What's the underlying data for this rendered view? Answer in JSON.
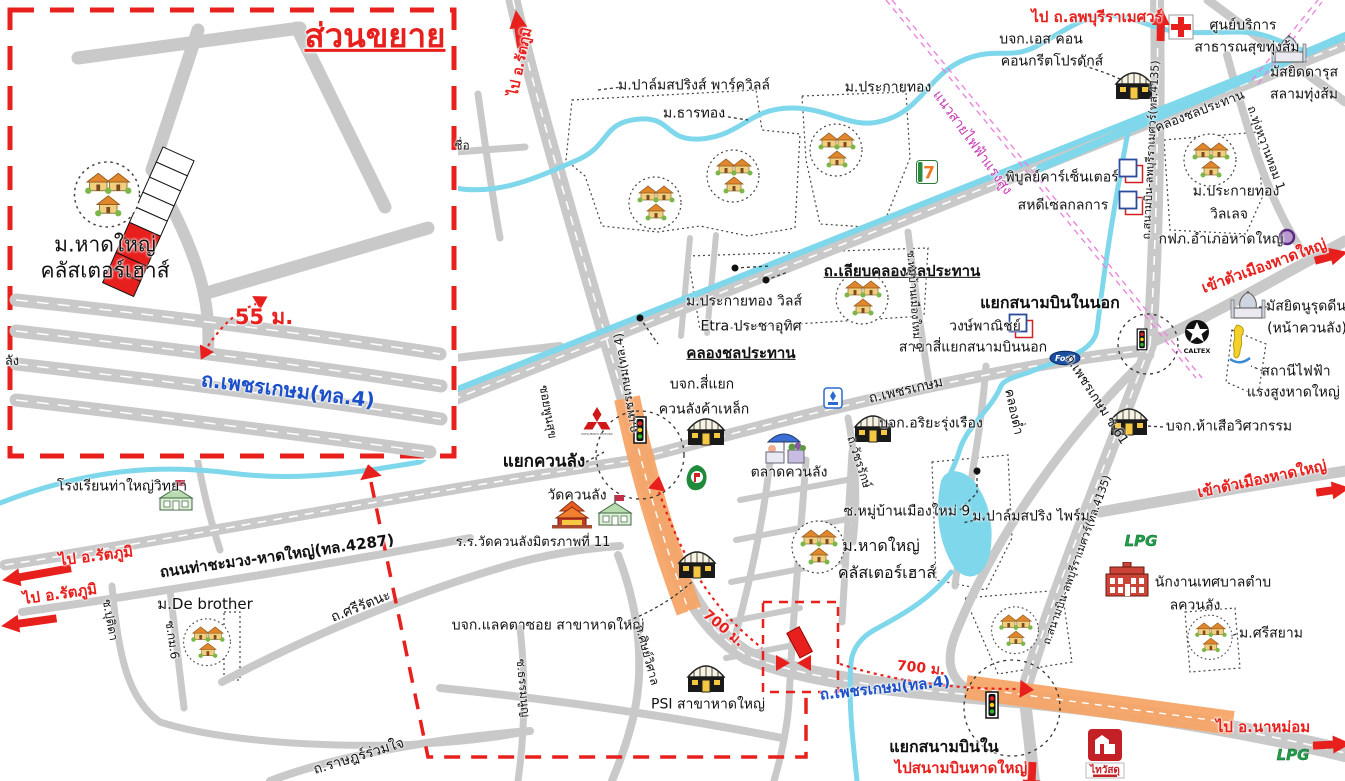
{
  "map_title": "ส่วนขยาย",
  "colors": {
    "road": "#c9c9c9",
    "water": "#7ed7ea",
    "red": "#e8201d",
    "blue": "#1b50c8",
    "magenta": "#ea86dc",
    "orange": "#f7a567"
  },
  "logos": {
    "seven": "7",
    "ford": "Ford",
    "caltex": "CALTEX",
    "lpg": "LPG",
    "thaiwatsadu": "ไทวัสดุ",
    "mitsubishi": "MITSUBISHI MOTORS"
  },
  "labels": [
    {
      "n": "inset-title",
      "t": "ส่วนขยาย",
      "x": 375,
      "y": 36,
      "fs": 33,
      "c": "red",
      "b": 1,
      "u": 1
    },
    {
      "n": "inset-site-name",
      "t": "ม.หาดใหญ่\nคลัสเตอร์เฮาส์",
      "x": 105,
      "y": 258,
      "fs": 21
    },
    {
      "n": "inset-distance",
      "t": "55 ม.",
      "x": 264,
      "y": 318,
      "fs": 21,
      "c": "red",
      "b": 1
    },
    {
      "n": "inset-road-phetkasem",
      "t": "ถ.เพชรเกษม(ทล.4)",
      "x": 288,
      "y": 390,
      "fs": 20,
      "c": "blue",
      "b": 1,
      "r": 7
    },
    {
      "n": "to-rattaphum-north",
      "t": "ไป อ.รัตภูมิ",
      "x": 521,
      "y": 62,
      "fs": 14,
      "c": "red",
      "b": 1,
      "r": -78
    },
    {
      "t": "ม.ปาล์มสปริงส์ พาร์ควิลล์",
      "x": 694,
      "y": 86,
      "fs": 14
    },
    {
      "t": "ม.ธารทอง",
      "x": 694,
      "y": 114,
      "fs": 14
    },
    {
      "t": "ม.ประกายทอง",
      "x": 888,
      "y": 88,
      "fs": 14
    },
    {
      "n": "to-lopburi-ramesuan",
      "t": "ไป ถ.ลพบุรีราเมศวร์",
      "x": 1097,
      "y": 17,
      "fs": 15,
      "c": "red",
      "b": 1
    },
    {
      "t": "บจก.เอส คอน",
      "x": 1041,
      "y": 40,
      "fs": 14
    },
    {
      "t": "คอนกรีตโปรดักส์",
      "x": 1052,
      "y": 62,
      "fs": 14
    },
    {
      "t": "ศูนย์บริการ",
      "x": 1243,
      "y": 26,
      "fs": 14
    },
    {
      "t": "สาธารณสุขทุ่งส้ม",
      "x": 1247,
      "y": 48,
      "fs": 14
    },
    {
      "t": "มัสยิดดารุส",
      "x": 1304,
      "y": 73,
      "fs": 14
    },
    {
      "t": "สลามทุ่งส้ม",
      "x": 1304,
      "y": 95,
      "fs": 14
    },
    {
      "n": "power-line-label",
      "t": "แนวสายไฟฟ้าแรงสูง",
      "x": 972,
      "y": 143,
      "fs": 14,
      "c": "#c73bb4",
      "r": 54
    },
    {
      "t": "คลองชลประทาน",
      "x": 1200,
      "y": 112,
      "fs": 13,
      "r": -21
    },
    {
      "t": "ถ.สนามบิน-ลพบุรีราเมศวร์(ทล.4135)",
      "x": 1151,
      "y": 150,
      "fs": 11,
      "r": -87
    },
    {
      "t": "พิบูลย์คาร์เซ็นเตอร์",
      "x": 1062,
      "y": 178,
      "fs": 14
    },
    {
      "t": "สหดีเซลกลการ",
      "x": 1063,
      "y": 206,
      "fs": 14
    },
    {
      "t": "ม.ประกายทอง",
      "x": 1236,
      "y": 192,
      "fs": 14
    },
    {
      "t": "วิลเลจ",
      "x": 1229,
      "y": 215,
      "fs": 14
    },
    {
      "t": "ถ.ทุ่งหวานหอม 1",
      "x": 1266,
      "y": 148,
      "fs": 12,
      "r": 70
    },
    {
      "t": "กฟภ.อำเภอหาดใหญ่",
      "x": 1221,
      "y": 240,
      "fs": 14
    },
    {
      "n": "to-hatyai-city-1",
      "t": "เข้าตัวเมืองหาดใหญ่",
      "x": 1264,
      "y": 266,
      "fs": 15,
      "c": "red",
      "b": 1,
      "r": -20
    },
    {
      "t": "มัสยิดนูรุดดีน",
      "x": 1306,
      "y": 307,
      "fs": 14
    },
    {
      "t": "(หน้าควนลัง)",
      "x": 1307,
      "y": 329,
      "fs": 14
    },
    {
      "t": "สถานีไฟฟ้า",
      "x": 1296,
      "y": 372,
      "fs": 14
    },
    {
      "t": "แรงสูงหาดใหญ่ 1",
      "x": 1300,
      "y": 393,
      "fs": 14
    },
    {
      "n": "junction-sanambin-nai-nok",
      "t": "แยกสนามบินในนอก",
      "x": 1050,
      "y": 303,
      "fs": 16,
      "b": 1
    },
    {
      "t": "วงษ์พาณิชย์",
      "x": 985,
      "y": 327,
      "fs": 14
    },
    {
      "t": "สาขาสี่แยกสนามบินนอก",
      "x": 973,
      "y": 348,
      "fs": 14
    },
    {
      "t": "ถ.เพชรเกษม",
      "x": 906,
      "y": 391,
      "fs": 14,
      "r": -13
    },
    {
      "t": "บจก.อริยะรุ่งเรือง",
      "x": 931,
      "y": 424,
      "fs": 14
    },
    {
      "t": "คลองต่ำ",
      "x": 1013,
      "y": 412,
      "fs": 13,
      "r": 78
    },
    {
      "t": "ถ.เพชรเกษม ซ.61",
      "x": 1096,
      "y": 400,
      "fs": 13,
      "r": 57
    },
    {
      "t": "บจก.ห้าเสือวิศวกรรม",
      "x": 1229,
      "y": 427,
      "fs": 14
    },
    {
      "t": "ถ.เลียบคลองชลประทาน",
      "x": 902,
      "y": 271,
      "fs": 15,
      "b": 1,
      "u": 1
    },
    {
      "t": "คลองชลประทาน",
      "x": 741,
      "y": 353,
      "fs": 15,
      "b": 1,
      "u": 1
    },
    {
      "t": "ม.ประกายทอง วิลส์",
      "x": 744,
      "y": 302,
      "fs": 14
    },
    {
      "t": "Etra ประชาอุทิศ",
      "x": 751,
      "y": 327,
      "fs": 14
    },
    {
      "t": "บจก.สี่แยก",
      "x": 702,
      "y": 385,
      "fs": 14
    },
    {
      "t": "ควนลังค้าเหล็ก",
      "x": 704,
      "y": 410,
      "fs": 14
    },
    {
      "n": "junction-khuan-lang",
      "t": "แยกควนลัง",
      "x": 544,
      "y": 462,
      "fs": 17,
      "b": 1
    },
    {
      "t": "วัดควนลัง",
      "x": 577,
      "y": 496,
      "fs": 14
    },
    {
      "t": "ร.ร.วัดควนลังมิตรภาพที่ 11",
      "x": 533,
      "y": 543,
      "fs": 13
    },
    {
      "t": "ถ.เพชรเกษม(ทล.4)",
      "x": 626,
      "y": 383,
      "fs": 12,
      "r": -99
    },
    {
      "t": "ตลาดควนลัง",
      "x": 789,
      "y": 473,
      "fs": 14
    },
    {
      "t": "ซ.หมู่บ้านเมืองใหม่ 9",
      "x": 907,
      "y": 512,
      "fs": 14
    },
    {
      "t": "ม.ปาล์มสปริง ไพร์ม",
      "x": 1031,
      "y": 517,
      "fs": 14
    },
    {
      "n": "site-name-1",
      "t": "ม.หาดใหญ่",
      "x": 881,
      "y": 546,
      "fs": 16
    },
    {
      "n": "site-name-2",
      "t": "คลัสเตอร์เฮาส์",
      "x": 887,
      "y": 573,
      "fs": 16
    },
    {
      "t": "บจก.แลคตาซอย สาขาหาดใหญ่",
      "x": 548,
      "y": 626,
      "fs": 14
    },
    {
      "t": "PSI สาขาหาดใหญ่",
      "x": 708,
      "y": 705,
      "fs": 14
    },
    {
      "n": "distance-700m-1",
      "t": "700 ม.",
      "x": 723,
      "y": 629,
      "fs": 14,
      "c": "red",
      "b": 1,
      "r": 40
    },
    {
      "n": "distance-700m-2",
      "t": "700 ม.",
      "x": 921,
      "y": 669,
      "fs": 14,
      "c": "red",
      "b": 1,
      "r": 6
    },
    {
      "n": "junction-sanambin-nai",
      "t": "แยกสนามบินใน",
      "x": 944,
      "y": 747,
      "fs": 16,
      "b": 1
    },
    {
      "n": "to-hatyai-airport",
      "t": "ไปสนามบินหาดใหญ่",
      "x": 961,
      "y": 768,
      "fs": 15,
      "c": "red",
      "b": 1
    },
    {
      "t": "ถ.เพชรเกษม(ทล.4)",
      "x": 885,
      "y": 688,
      "fs": 15,
      "c": "blue",
      "b": 1,
      "r": -6
    },
    {
      "n": "to-namom",
      "t": "ไป อ.นาหม่อม",
      "x": 1263,
      "y": 727,
      "fs": 15,
      "c": "red",
      "b": 1
    },
    {
      "t": "นักงานเทศบาลตำบ",
      "x": 1213,
      "y": 583,
      "fs": 14
    },
    {
      "t": "ลควนลัง",
      "x": 1195,
      "y": 606,
      "fs": 14
    },
    {
      "t": "ม.ศรีสยาม",
      "x": 1271,
      "y": 634,
      "fs": 14
    },
    {
      "t": "โรงเรียนท่าใหญ่วิทยา",
      "x": 122,
      "y": 487,
      "fs": 14
    },
    {
      "n": "to-rattaphum-west-1",
      "t": "ไป อ.รัตภูมิ",
      "x": 96,
      "y": 556,
      "fs": 15,
      "c": "red",
      "b": 1,
      "r": -7
    },
    {
      "n": "to-rattaphum-west-2",
      "t": "ไป อ.รัตภูมิ",
      "x": 60,
      "y": 594,
      "fs": 15,
      "c": "red",
      "b": 1,
      "r": -8
    },
    {
      "t": "ถนนท่าชะมวง-หาดใหญ่(ทล.4287)",
      "x": 277,
      "y": 556,
      "fs": 15,
      "b": 1,
      "r": -8
    },
    {
      "t": "ม.De brother",
      "x": 205,
      "y": 604,
      "fs": 15
    },
    {
      "t": "ถ.ศรีรัตนะ",
      "x": 361,
      "y": 607,
      "fs": 14,
      "r": -22
    },
    {
      "t": "ถ.ราษฎร์ร่วมใจ",
      "x": 359,
      "y": 757,
      "fs": 14,
      "r": -17
    },
    {
      "t": "ซ.ปุติดา",
      "x": 110,
      "y": 620,
      "fs": 12,
      "r": 80
    },
    {
      "t": "ซ.กม.6",
      "x": 172,
      "y": 640,
      "fs": 12,
      "r": 82
    },
    {
      "t": "ซ.ธรรมนูญ",
      "x": 523,
      "y": 688,
      "fs": 12,
      "r": 85
    },
    {
      "t": "ถ.ศิษย์วิศาล",
      "x": 647,
      "y": 655,
      "fs": 12,
      "r": 75
    },
    {
      "t": "ซอยพูนสุข",
      "x": 548,
      "y": 412,
      "fs": 12,
      "r": 80
    },
    {
      "t": "ถ.วัชรรักษ์",
      "x": 859,
      "y": 462,
      "fs": 12,
      "r": 72
    },
    {
      "t": "ซ.หมู่บ้านเมืองใหม่ 9",
      "x": 914,
      "y": 300,
      "fs": 11,
      "r": 86
    },
    {
      "t": "ชื่อ",
      "x": 462,
      "y": 146,
      "fs": 12
    },
    {
      "t": "ลัง",
      "x": 12,
      "y": 362,
      "fs": 13
    },
    {
      "t": "ถ.สนามบิน-ลพบุรีราเมศวร์(ทล.4135)",
      "x": 1077,
      "y": 560,
      "fs": 11,
      "r": -70
    },
    {
      "n": "to-hatyai-city-2",
      "t": "เข้าตัวเมืองหาดใหญ่",
      "x": 1262,
      "y": 479,
      "fs": 15,
      "c": "red",
      "b": 1,
      "r": -12
    }
  ],
  "icons": [
    {
      "n": "houses-cluster-icon",
      "t": "houses",
      "x": 107,
      "y": 197,
      "s": 1.25
    },
    {
      "n": "houses-cluster-icon",
      "t": "houses",
      "x": 655,
      "y": 205
    },
    {
      "n": "houses-cluster-icon",
      "t": "houses",
      "x": 733,
      "y": 178
    },
    {
      "n": "houses-cluster-icon",
      "t": "houses",
      "x": 836,
      "y": 152
    },
    {
      "n": "houses-cluster-icon",
      "t": "houses",
      "x": 1210,
      "y": 162
    },
    {
      "n": "houses-cluster-icon",
      "t": "houses",
      "x": 862,
      "y": 300
    },
    {
      "n": "houses-cluster-icon",
      "t": "houses",
      "x": 818,
      "y": 549
    },
    {
      "n": "houses-cluster-icon",
      "t": "houses",
      "x": 1015,
      "y": 632,
      "s": 0.9
    },
    {
      "n": "houses-cluster-icon",
      "t": "houses",
      "x": 1210,
      "y": 639,
      "s": 0.85
    },
    {
      "n": "houses-cluster-icon",
      "t": "houses",
      "x": 207,
      "y": 644,
      "s": 0.9
    },
    {
      "n": "warehouse-icon",
      "t": "warehouse",
      "x": 1134,
      "y": 88
    },
    {
      "n": "warehouse-icon",
      "t": "warehouse",
      "x": 706,
      "y": 434
    },
    {
      "n": "warehouse-icon",
      "t": "warehouse",
      "x": 873,
      "y": 431
    },
    {
      "n": "warehouse-icon",
      "t": "warehouse",
      "x": 1129,
      "y": 424
    },
    {
      "n": "warehouse-icon",
      "t": "warehouse",
      "x": 697,
      "y": 567
    },
    {
      "n": "warehouse-icon",
      "t": "warehouse",
      "x": 706,
      "y": 681
    },
    {
      "n": "mosque-icon",
      "t": "mosque",
      "x": 1289,
      "y": 51
    },
    {
      "n": "mosque-icon",
      "t": "mosque",
      "x": 1248,
      "y": 307
    },
    {
      "n": "temple-icon",
      "t": "temple",
      "x": 572,
      "y": 516
    },
    {
      "n": "school-icon",
      "t": "school",
      "x": 615,
      "y": 512
    },
    {
      "n": "school-icon",
      "t": "school",
      "x": 176,
      "y": 497
    },
    {
      "n": "market-icon",
      "t": "market",
      "x": 788,
      "y": 451
    },
    {
      "n": "municipal-office-icon",
      "t": "office",
      "x": 1127,
      "y": 582
    },
    {
      "n": "health-center-icon",
      "t": "redcross",
      "x": 1181,
      "y": 29
    },
    {
      "n": "seven-eleven-icon",
      "t": "seven",
      "x": 927,
      "y": 174
    },
    {
      "n": "mitsubishi-logo-icon",
      "t": "mitsubishi",
      "x": 597,
      "y": 424
    },
    {
      "n": "ford-logo-icon",
      "t": "ford",
      "x": 1065,
      "y": 360
    },
    {
      "n": "caltex-logo-icon",
      "t": "caltex",
      "x": 1197,
      "y": 340
    },
    {
      "n": "pt-station-icon",
      "t": "pt",
      "x": 697,
      "y": 480
    },
    {
      "n": "pea-logo-icon",
      "t": "pea",
      "x": 1287,
      "y": 239
    },
    {
      "n": "lpg-icon",
      "t": "lpg",
      "x": 1141,
      "y": 543
    },
    {
      "n": "lpg-icon",
      "t": "lpg",
      "x": 1293,
      "y": 757
    },
    {
      "n": "thaiwatsadu-logo-icon",
      "t": "thaiwatsadu",
      "x": 1105,
      "y": 756
    },
    {
      "n": "shop-squares-icon",
      "t": "squares",
      "x": 1021,
      "y": 328
    },
    {
      "n": "shop-squares-icon",
      "t": "squares",
      "x": 1131,
      "y": 173
    },
    {
      "n": "shop-squares-icon",
      "t": "squares",
      "x": 1131,
      "y": 205
    },
    {
      "n": "traffic-light-icon",
      "t": "trafficlight",
      "x": 640,
      "y": 432
    },
    {
      "n": "traffic-light-icon",
      "t": "trafficlight",
      "x": 992,
      "y": 707
    },
    {
      "n": "traffic-light-icon",
      "t": "trafficlight",
      "x": 1142,
      "y": 341,
      "s": 0.8
    },
    {
      "n": "thailand-map-icon",
      "t": "thaimap",
      "x": 1240,
      "y": 347
    },
    {
      "n": "blue-logo-icon",
      "t": "bluelogo",
      "x": 833,
      "y": 400
    },
    {
      "n": "red-arrow-icon",
      "t": "arrow",
      "x": 517,
      "y": 5,
      "r": -98,
      "len": 30
    },
    {
      "n": "red-arrow-icon",
      "t": "arrow",
      "x": 1161,
      "y": 2,
      "r": -89,
      "len": 26
    },
    {
      "n": "red-arrow-icon",
      "t": "arrow",
      "x": 1340,
      "y": 241,
      "r": -15,
      "len": 26
    },
    {
      "n": "red-arrow-icon",
      "t": "arrow",
      "x": 1342,
      "y": 476,
      "r": -8,
      "len": 26
    },
    {
      "n": "red-arrow-icon",
      "t": "arrow",
      "x": 10,
      "y": 566,
      "r": 170,
      "len": 62
    },
    {
      "n": "red-arrow-icon",
      "t": "arrow",
      "x": 9,
      "y": 612,
      "r": 172,
      "len": 48
    },
    {
      "n": "red-arrow-icon",
      "t": "arrow",
      "x": 1343,
      "y": 731,
      "r": -3,
      "len": 30
    },
    {
      "n": "red-arrow-icon",
      "t": "arrow",
      "x": 1031,
      "y": 777,
      "r": 93,
      "len": 28
    }
  ]
}
